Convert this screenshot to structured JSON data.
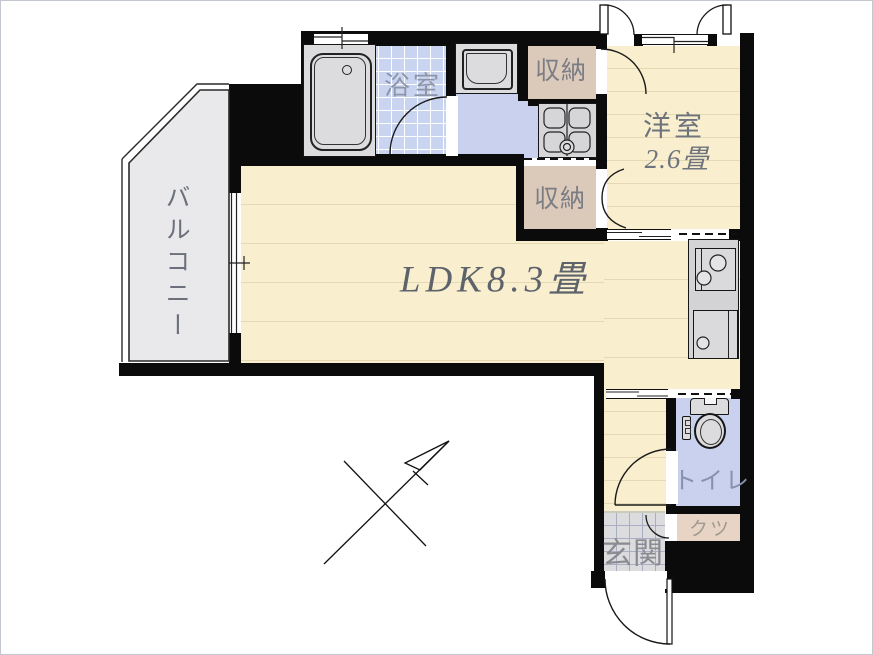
{
  "plan": {
    "type": "apartment-floor-plan",
    "rooms": {
      "ldk": {
        "label": "LDK8.3畳"
      },
      "western": {
        "label": "洋室",
        "size": "2.6畳"
      },
      "balcony": {
        "label": "バルコニー"
      },
      "bathroom": {
        "label": "浴室"
      },
      "storage_upper": {
        "label": "収納"
      },
      "storage_lower": {
        "label": "収納"
      },
      "toilet": {
        "label": "トイレ"
      },
      "shoes": {
        "label": "クツ"
      },
      "entrance": {
        "label": "玄関"
      }
    },
    "fixtures": [
      "bathtub",
      "washbasin",
      "washing-machine-pan",
      "stove",
      "kitchen-sink",
      "kitchen-counter",
      "toilet-fixture",
      "north-arrow"
    ],
    "colors": {
      "wall": "#0b0b0b",
      "wood_floor": "#f9efcf",
      "wood_line": "#e4d9b4",
      "bath_tile": "#c9d4f0",
      "wet_area": "#c9d1ee",
      "storage": "#dbc9b9",
      "shoes_box": "#e7d4c4",
      "entrance_tile": "#dcdcdf",
      "balcony": "#e9e9ec",
      "fixture_gray": "#dcdcde",
      "text": "#6a6f7a"
    }
  }
}
